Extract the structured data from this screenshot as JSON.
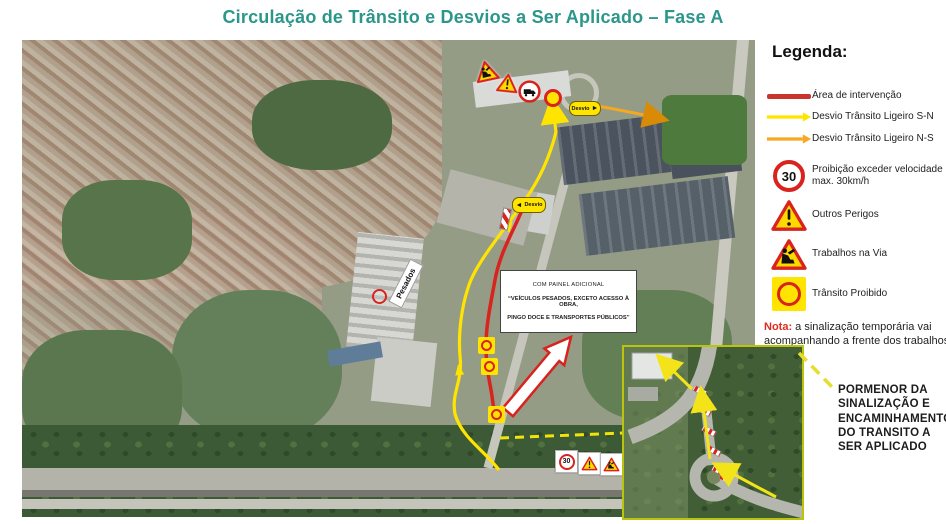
{
  "title": "Circulação de Trânsito e Desvios a Ser Aplicado – Fase A",
  "colors": {
    "title_teal": "#2B968A",
    "intervention_red": "#D8231F",
    "detour_yellow": "#FFE400",
    "detour_orange": "#F7A823",
    "note_red": "#E02B20",
    "inset_border_green": "#B9C40A"
  },
  "legend": {
    "heading": "Legenda:",
    "items": [
      {
        "icon": "red-line",
        "label": "Área de intervenção"
      },
      {
        "icon": "yellow-arrow",
        "label": "Desvio Trânsito Ligeiro S-N"
      },
      {
        "icon": "orange-arrow",
        "label": "Desvio Trânsito Ligeiro N-S"
      },
      {
        "icon": "speed-limit-30-sign",
        "label": "Proibição exceder velocidade max. 30km/h",
        "value": "30"
      },
      {
        "icon": "exclamation-triangle-sign",
        "label": "Outros Perigos"
      },
      {
        "icon": "roadworks-triangle-sign",
        "label": "Trabalhos na Via"
      },
      {
        "icon": "no-traffic-yellow-square-sign",
        "label": "Trânsito Proibido"
      }
    ],
    "note_prefix": "Nota:",
    "note_text": "a sinalização temporária vai acompanhando a frente dos trabalhos"
  },
  "map": {
    "panel": {
      "line1": "COM PAINEL ADICIONAL",
      "line2": "“VEÍCULOS PESADOS, EXCETO ACESSO À OBRA,",
      "line3": "PINGO DOCE E TRANSPORTES PÚBLICOS”"
    },
    "labels": {
      "pesados": "Pesados",
      "desvio": "Desvio",
      "speed_30": "30"
    }
  },
  "inset": {
    "caption": "PORMENOR DA SINALIZAÇÃO E ENCAMINHAMENTO DO TRANSITO A SER APLICADO"
  }
}
